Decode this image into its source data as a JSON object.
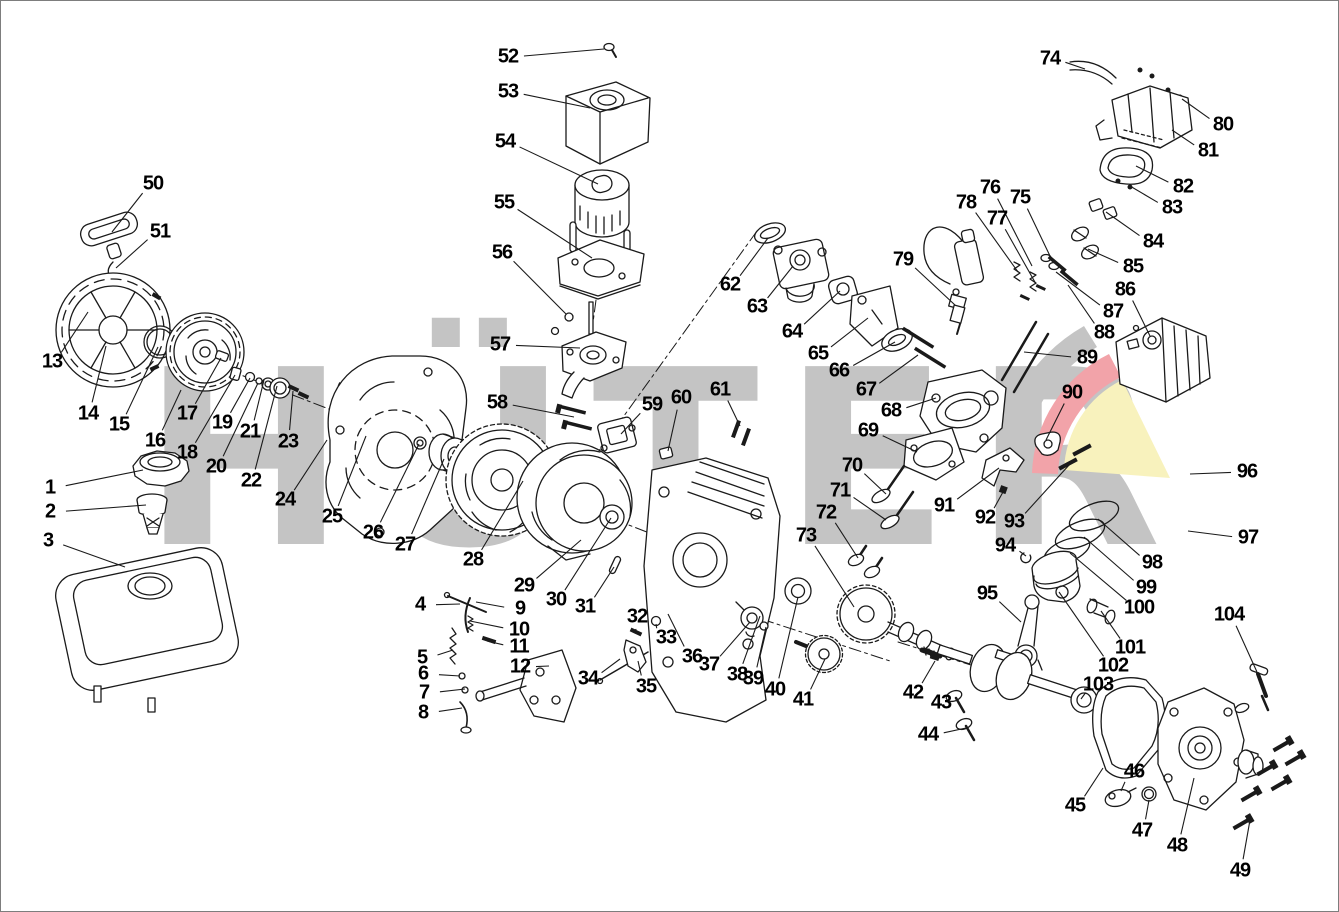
{
  "watermark": {
    "text": "HÜTER"
  },
  "colors": {
    "background": "#ffffff",
    "frame_border": "#7d7d7d",
    "line_art": "#1a1a1a",
    "label_text": "#000000",
    "watermark_gray": "#c4c4c4",
    "swoosh_red": "#f2a3a9",
    "swoosh_yellow": "#f8f2bd",
    "swoosh_gray": "#c4c4c4"
  },
  "callouts": [
    {
      "n": "1",
      "x": 50,
      "y": 488,
      "tx": 143,
      "ty": 470
    },
    {
      "n": "2",
      "x": 50,
      "y": 512,
      "tx": 146,
      "ty": 505
    },
    {
      "n": "3",
      "x": 48,
      "y": 541,
      "tx": 125,
      "ty": 567
    },
    {
      "n": "4",
      "x": 420,
      "y": 605,
      "tx": 460,
      "ty": 604
    },
    {
      "n": "5",
      "x": 422,
      "y": 658,
      "tx": 453,
      "ty": 650
    },
    {
      "n": "6",
      "x": 423,
      "y": 674,
      "tx": 460,
      "ty": 676
    },
    {
      "n": "7",
      "x": 424,
      "y": 693,
      "tx": 465,
      "ty": 689
    },
    {
      "n": "8",
      "x": 423,
      "y": 713,
      "tx": 462,
      "ty": 708
    },
    {
      "n": "9",
      "x": 520,
      "y": 609,
      "tx": 476,
      "ty": 602
    },
    {
      "n": "10",
      "x": 519,
      "y": 630,
      "tx": 470,
      "ty": 621
    },
    {
      "n": "11",
      "x": 519,
      "y": 647,
      "tx": 487,
      "ty": 641
    },
    {
      "n": "12",
      "x": 520,
      "y": 667,
      "tx": 549,
      "ty": 666
    },
    {
      "n": "13",
      "x": 52,
      "y": 362,
      "tx": 88,
      "ty": 312
    },
    {
      "n": "14",
      "x": 88,
      "y": 414,
      "tx": 106,
      "ty": 346
    },
    {
      "n": "15",
      "x": 119,
      "y": 425,
      "tx": 158,
      "ty": 347
    },
    {
      "n": "16",
      "x": 155,
      "y": 441,
      "tx": 181,
      "ty": 390
    },
    {
      "n": "17",
      "x": 187,
      "y": 414,
      "tx": 221,
      "ty": 358
    },
    {
      "n": "18",
      "x": 187,
      "y": 453,
      "tx": 235,
      "ty": 375
    },
    {
      "n": "19",
      "x": 222,
      "y": 423,
      "tx": 250,
      "ty": 378
    },
    {
      "n": "20",
      "x": 216,
      "y": 467,
      "tx": 258,
      "ty": 383
    },
    {
      "n": "21",
      "x": 250,
      "y": 432,
      "tx": 264,
      "ty": 380
    },
    {
      "n": "22",
      "x": 251,
      "y": 481,
      "tx": 277,
      "ty": 386
    },
    {
      "n": "23",
      "x": 288,
      "y": 442,
      "tx": 293,
      "ty": 391
    },
    {
      "n": "24",
      "x": 285,
      "y": 500,
      "tx": 327,
      "ty": 440
    },
    {
      "n": "25",
      "x": 332,
      "y": 517,
      "tx": 366,
      "ty": 436
    },
    {
      "n": "26",
      "x": 373,
      "y": 533,
      "tx": 419,
      "ty": 444
    },
    {
      "n": "27",
      "x": 405,
      "y": 545,
      "tx": 444,
      "ty": 459
    },
    {
      "n": "28",
      "x": 473,
      "y": 560,
      "tx": 523,
      "ty": 481
    },
    {
      "n": "29",
      "x": 524,
      "y": 586,
      "tx": 581,
      "ty": 540
    },
    {
      "n": "30",
      "x": 556,
      "y": 600,
      "tx": 611,
      "ty": 518
    },
    {
      "n": "31",
      "x": 585,
      "y": 607,
      "tx": 614,
      "ty": 567
    },
    {
      "n": "32",
      "x": 637,
      "y": 617,
      "tx": 636,
      "ty": 631
    },
    {
      "n": "33",
      "x": 666,
      "y": 638,
      "tx": 656,
      "ty": 624
    },
    {
      "n": "34",
      "x": 588,
      "y": 679,
      "tx": 620,
      "ty": 659
    },
    {
      "n": "35",
      "x": 646,
      "y": 687,
      "tx": 638,
      "ty": 661
    },
    {
      "n": "36",
      "x": 692,
      "y": 657,
      "tx": 668,
      "ty": 614
    },
    {
      "n": "37",
      "x": 709,
      "y": 665,
      "tx": 750,
      "ty": 622
    },
    {
      "n": "38",
      "x": 737,
      "y": 675,
      "tx": 760,
      "ty": 616
    },
    {
      "n": "39",
      "x": 753,
      "y": 679,
      "tx": 766,
      "ty": 627
    },
    {
      "n": "40",
      "x": 775,
      "y": 690,
      "tx": 798,
      "ty": 597
    },
    {
      "n": "41",
      "x": 803,
      "y": 700,
      "tx": 825,
      "ty": 659
    },
    {
      "n": "42",
      "x": 913,
      "y": 693,
      "tx": 935,
      "ty": 661
    },
    {
      "n": "43",
      "x": 941,
      "y": 703,
      "tx": 956,
      "ty": 698
    },
    {
      "n": "44",
      "x": 928,
      "y": 735,
      "tx": 966,
      "ty": 728
    },
    {
      "n": "45",
      "x": 1075,
      "y": 806,
      "tx": 1103,
      "ty": 768
    },
    {
      "n": "46",
      "x": 1134,
      "y": 772,
      "tx": 1121,
      "ty": 791
    },
    {
      "n": "47",
      "x": 1142,
      "y": 831,
      "tx": 1149,
      "ty": 800
    },
    {
      "n": "48",
      "x": 1177,
      "y": 846,
      "tx": 1194,
      "ty": 778
    },
    {
      "n": "49",
      "x": 1240,
      "y": 871,
      "tx": 1250,
      "ty": 820
    },
    {
      "n": "50",
      "x": 153,
      "y": 184,
      "tx": 112,
      "ty": 232
    },
    {
      "n": "51",
      "x": 160,
      "y": 232,
      "tx": 116,
      "ty": 268
    },
    {
      "n": "52",
      "x": 508,
      "y": 57,
      "tx": 604,
      "ty": 49
    },
    {
      "n": "53",
      "x": 508,
      "y": 92,
      "tx": 590,
      "ty": 108
    },
    {
      "n": "54",
      "x": 505,
      "y": 142,
      "tx": 598,
      "ty": 184
    },
    {
      "n": "55",
      "x": 504,
      "y": 203,
      "tx": 592,
      "ty": 258
    },
    {
      "n": "56",
      "x": 502,
      "y": 253,
      "tx": 566,
      "ty": 314
    },
    {
      "n": "57",
      "x": 500,
      "y": 345,
      "tx": 580,
      "ty": 348
    },
    {
      "n": "58",
      "x": 497,
      "y": 403,
      "tx": 574,
      "ty": 417
    },
    {
      "n": "59",
      "x": 652,
      "y": 405,
      "tx": 621,
      "ty": 434
    },
    {
      "n": "60",
      "x": 681,
      "y": 398,
      "tx": 668,
      "ty": 451
    },
    {
      "n": "61",
      "x": 720,
      "y": 390,
      "tx": 740,
      "ty": 426
    },
    {
      "n": "62",
      "x": 730,
      "y": 285,
      "tx": 768,
      "ty": 238
    },
    {
      "n": "63",
      "x": 757,
      "y": 307,
      "tx": 793,
      "ty": 266
    },
    {
      "n": "64",
      "x": 792,
      "y": 332,
      "tx": 840,
      "ty": 291
    },
    {
      "n": "65",
      "x": 818,
      "y": 354,
      "tx": 868,
      "ty": 318
    },
    {
      "n": "66",
      "x": 839,
      "y": 371,
      "tx": 895,
      "ty": 342
    },
    {
      "n": "67",
      "x": 866,
      "y": 390,
      "tx": 918,
      "ty": 355
    },
    {
      "n": "68",
      "x": 891,
      "y": 411,
      "tx": 936,
      "ty": 398
    },
    {
      "n": "69",
      "x": 868,
      "y": 431,
      "tx": 917,
      "ty": 452
    },
    {
      "n": "70",
      "x": 852,
      "y": 466,
      "tx": 886,
      "ty": 494
    },
    {
      "n": "71",
      "x": 840,
      "y": 491,
      "tx": 886,
      "ty": 520
    },
    {
      "n": "72",
      "x": 826,
      "y": 513,
      "tx": 858,
      "ty": 558
    },
    {
      "n": "73",
      "x": 806,
      "y": 536,
      "tx": 854,
      "ty": 607
    },
    {
      "n": "74",
      "x": 1050,
      "y": 59,
      "tx": 1085,
      "ty": 69
    },
    {
      "n": "75",
      "x": 1020,
      "y": 198,
      "tx": 1050,
      "ty": 256
    },
    {
      "n": "76",
      "x": 990,
      "y": 188,
      "tx": 1032,
      "ty": 266
    },
    {
      "n": "77",
      "x": 997,
      "y": 219,
      "tx": 1036,
      "ty": 284
    },
    {
      "n": "78",
      "x": 966,
      "y": 203,
      "tx": 1018,
      "ty": 272
    },
    {
      "n": "79",
      "x": 903,
      "y": 260,
      "tx": 955,
      "ty": 305
    },
    {
      "n": "80",
      "x": 1223,
      "y": 125,
      "tx": 1182,
      "ty": 99
    },
    {
      "n": "81",
      "x": 1208,
      "y": 151,
      "tx": 1172,
      "ty": 130
    },
    {
      "n": "82",
      "x": 1183,
      "y": 187,
      "tx": 1136,
      "ty": 166
    },
    {
      "n": "83",
      "x": 1172,
      "y": 208,
      "tx": 1130,
      "ty": 186
    },
    {
      "n": "84",
      "x": 1153,
      "y": 242,
      "tx": 1106,
      "ty": 212
    },
    {
      "n": "85",
      "x": 1133,
      "y": 267,
      "tx": 1088,
      "ty": 249
    },
    {
      "n": "86",
      "x": 1125,
      "y": 290,
      "tx": 1150,
      "ty": 336
    },
    {
      "n": "87",
      "x": 1113,
      "y": 312,
      "tx": 1056,
      "ty": 272
    },
    {
      "n": "88",
      "x": 1104,
      "y": 333,
      "tx": 1068,
      "ty": 285
    },
    {
      "n": "89",
      "x": 1087,
      "y": 358,
      "tx": 1024,
      "ty": 352
    },
    {
      "n": "90",
      "x": 1072,
      "y": 393,
      "tx": 1046,
      "ty": 440
    },
    {
      "n": "91",
      "x": 944,
      "y": 506,
      "tx": 999,
      "ty": 468
    },
    {
      "n": "92",
      "x": 985,
      "y": 518,
      "tx": 1003,
      "ty": 492
    },
    {
      "n": "93",
      "x": 1014,
      "y": 522,
      "tx": 1070,
      "ty": 464
    },
    {
      "n": "94",
      "x": 1005,
      "y": 546,
      "tx": 1026,
      "ty": 556
    },
    {
      "n": "95",
      "x": 987,
      "y": 594,
      "tx": 1021,
      "ty": 622
    },
    {
      "n": "96",
      "x": 1247,
      "y": 472,
      "tx": 1190,
      "ty": 474
    },
    {
      "n": "97",
      "x": 1248,
      "y": 538,
      "tx": 1188,
      "ty": 531
    },
    {
      "n": "98",
      "x": 1152,
      "y": 563,
      "tx": 1098,
      "ty": 519
    },
    {
      "n": "99",
      "x": 1146,
      "y": 588,
      "tx": 1084,
      "ty": 537
    },
    {
      "n": "100",
      "x": 1139,
      "y": 608,
      "tx": 1070,
      "ty": 553
    },
    {
      "n": "101",
      "x": 1130,
      "y": 648,
      "tx": 1101,
      "ty": 611
    },
    {
      "n": "102",
      "x": 1113,
      "y": 666,
      "tx": 1059,
      "ty": 592
    },
    {
      "n": "103",
      "x": 1098,
      "y": 685,
      "tx": 1081,
      "ty": 699
    },
    {
      "n": "104",
      "x": 1229,
      "y": 615,
      "tx": 1257,
      "ty": 672
    }
  ]
}
